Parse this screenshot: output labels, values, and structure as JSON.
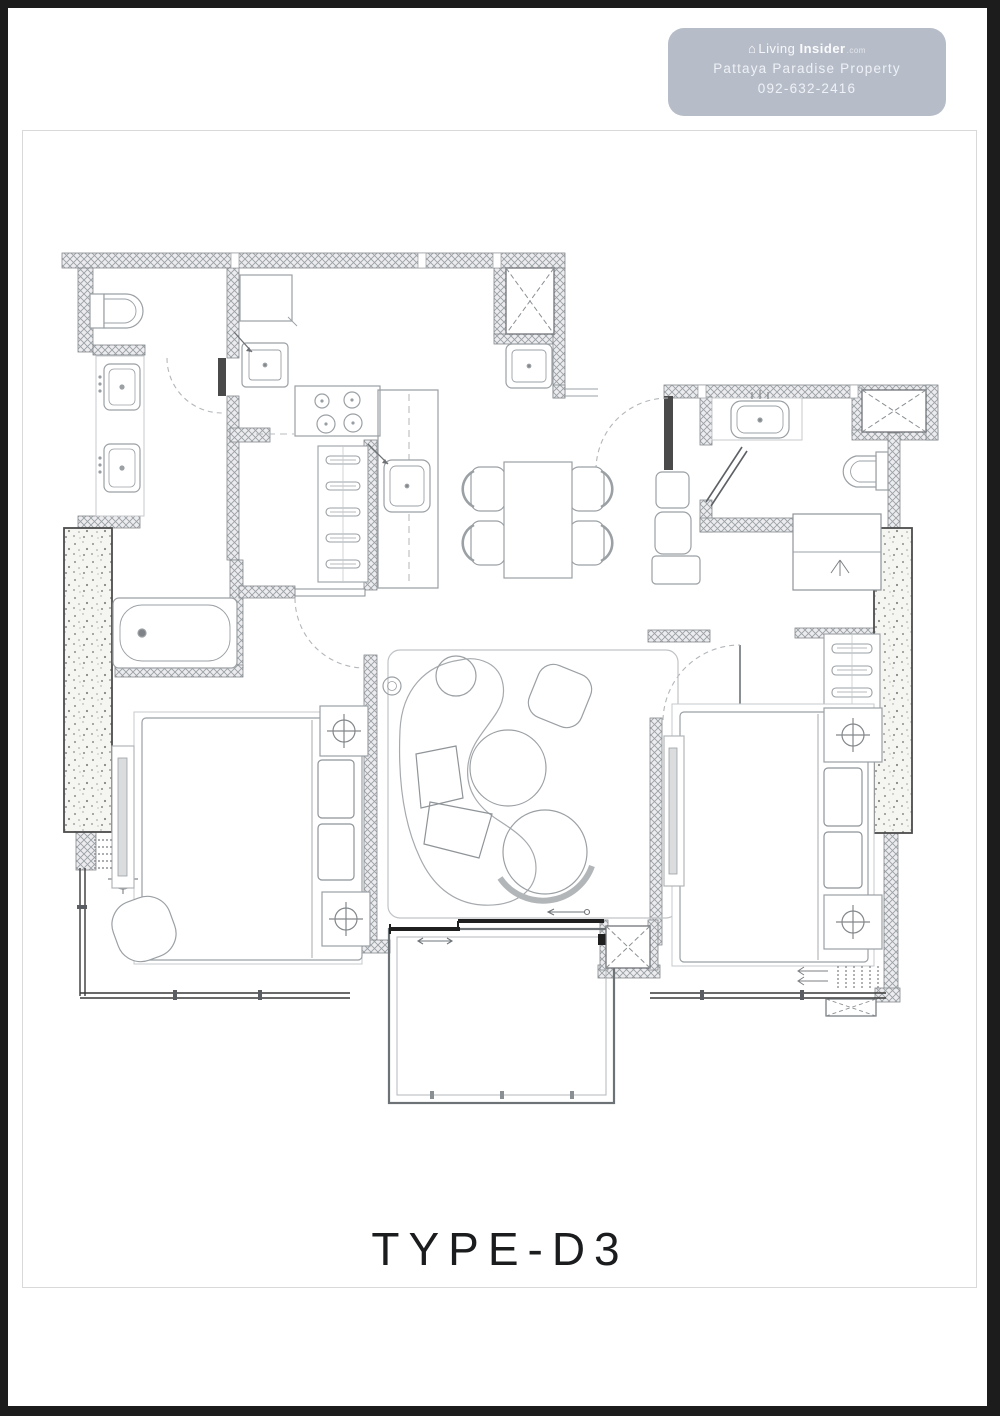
{
  "badge": {
    "brand_living": "Living",
    "brand_insider": "Insider",
    "brand_suffix": ".com",
    "agency": "Pattaya Paradise Property",
    "phone": "092-632-2416"
  },
  "title": "TYPE-D3",
  "colors": {
    "badge_bg": "#b2b8c4",
    "badge_text": "#f2f4f8",
    "wall_hatch_line": "#9aa0a5",
    "thin_wall": "#383838",
    "furniture_line": "#9ba0a4",
    "door_dash": "#b3b7ba",
    "title_text": "#1b1c1e",
    "page_border": "#1c1c1c",
    "frame_border": "#d9d9d9"
  }
}
